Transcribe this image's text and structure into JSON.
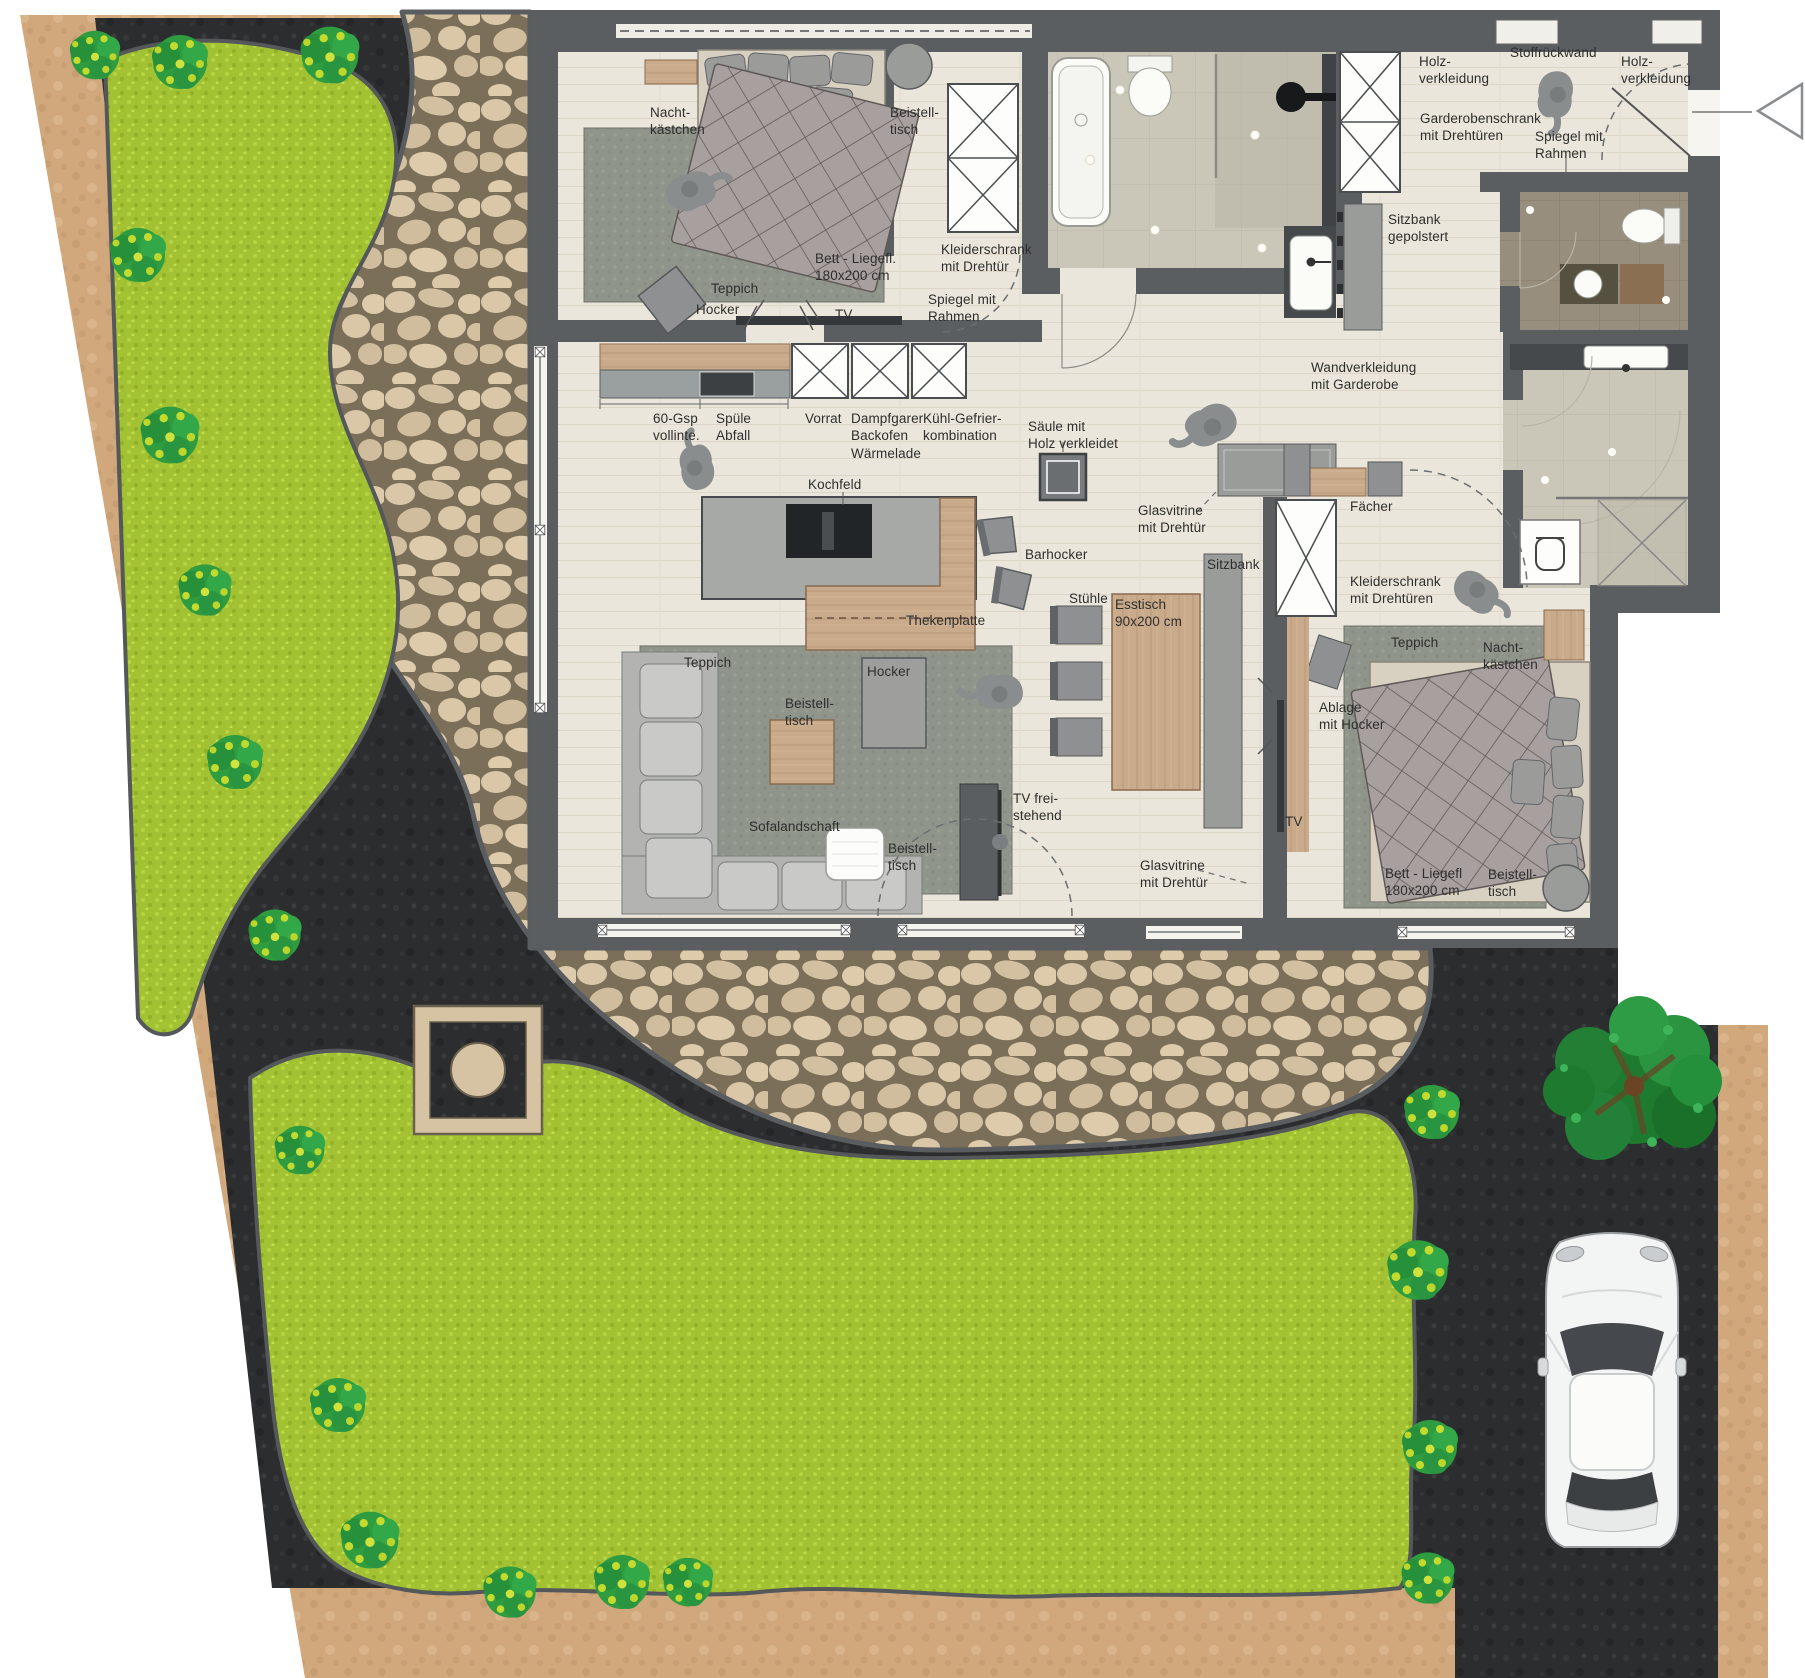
{
  "plan": {
    "canvas": {
      "width": 1805,
      "height": 1678
    },
    "type": "apartment-floor-plan-with-garden",
    "colors": {
      "lawn": "#a2c233",
      "ground": "#2c2d2e",
      "path": "#d0a87c",
      "stone": "#d9c7a8",
      "wall": "#5a5e61",
      "floor": "#ebe6db",
      "furniture_gray": "#9a9c9a",
      "wood": "#c9aa8a",
      "accent_dark": "#36393b"
    },
    "entry_marker": {
      "name": "entry-direction-arrow",
      "shape": "triangle-pointing-left"
    },
    "labels": [
      {
        "id": "bed1-nachtkaestchen",
        "text": "Nacht-\nkästchen",
        "x": 650,
        "y": 104
      },
      {
        "id": "bed1-beistelltisch",
        "text": "Beistell-\ntisch",
        "x": 890,
        "y": 104
      },
      {
        "id": "bed1-bett",
        "text": "Bett - Liegefl.\n180x200 cm",
        "x": 815,
        "y": 250
      },
      {
        "id": "bed1-teppich",
        "text": "Teppich",
        "x": 711,
        "y": 280
      },
      {
        "id": "bed1-hocker",
        "text": "Hocker",
        "x": 696,
        "y": 301
      },
      {
        "id": "bed1-tv",
        "text": "TV",
        "x": 835,
        "y": 306
      },
      {
        "id": "bed1-kleiderschrank",
        "text": "Kleiderschrank\nmit Drehtür",
        "x": 941,
        "y": 241
      },
      {
        "id": "bed1-spiegel",
        "text": "Spiegel mit\nRahmen",
        "x": 928,
        "y": 291
      },
      {
        "id": "kitchen-gsp",
        "text": "60-Gsp\nvollinte.",
        "x": 653,
        "y": 410
      },
      {
        "id": "kitchen-spuele",
        "text": "Spüle\nAbfall",
        "x": 716,
        "y": 410
      },
      {
        "id": "kitchen-vorrat",
        "text": "Vorrat",
        "x": 805,
        "y": 410
      },
      {
        "id": "kitchen-dampfgarer",
        "text": "Dampfgarer\nBackofen\nWärmelade",
        "x": 851,
        "y": 410
      },
      {
        "id": "kitchen-kuehl",
        "text": "Kühl-Gefrier-\nkombination",
        "x": 923,
        "y": 410
      },
      {
        "id": "kitchen-kochfeld",
        "text": "Kochfeld",
        "x": 808,
        "y": 476
      },
      {
        "id": "kitchen-thekenplatte",
        "text": "Thekenplatte",
        "x": 906,
        "y": 612
      },
      {
        "id": "kitchen-barhocker",
        "text": "Barhocker",
        "x": 1025,
        "y": 546
      },
      {
        "id": "kitchen-saeule",
        "text": "Säule mit\nHolz verkleidet",
        "x": 1028,
        "y": 418
      },
      {
        "id": "dining-stuehle",
        "text": "Stühle",
        "x": 1069,
        "y": 590
      },
      {
        "id": "dining-esstisch",
        "text": "Esstisch\n90x200 cm",
        "x": 1115,
        "y": 596
      },
      {
        "id": "dining-sitzbank",
        "text": "Sitzbank",
        "x": 1207,
        "y": 556
      },
      {
        "id": "dining-glasvitrine",
        "text": "Glasvitrine\nmit Drehtür",
        "x": 1138,
        "y": 502
      },
      {
        "id": "living-glasvitrine",
        "text": "Glasvitrine\nmit Drehtür",
        "x": 1140,
        "y": 857
      },
      {
        "id": "hall-wandverkleidung",
        "text": "Wandverkleidung\nmit Garderobe",
        "x": 1311,
        "y": 359
      },
      {
        "id": "entry-holz-left",
        "text": "Holz-\nverkleidung",
        "x": 1419,
        "y": 53
      },
      {
        "id": "entry-stoffrueckwand",
        "text": "Stoffrückwand",
        "x": 1510,
        "y": 44
      },
      {
        "id": "entry-holz-right",
        "text": "Holz-\nverkleidung",
        "x": 1621,
        "y": 53
      },
      {
        "id": "entry-garderobenschrank",
        "text": "Garderobenschrank\nmit Drehtüren",
        "x": 1420,
        "y": 110
      },
      {
        "id": "entry-spiegel",
        "text": "Spiegel mit\nRahmen",
        "x": 1535,
        "y": 128
      },
      {
        "id": "entry-sitzbank",
        "text": "Sitzbank\ngepolstert",
        "x": 1388,
        "y": 211
      },
      {
        "id": "bed2-faecher",
        "text": "Fächer",
        "x": 1350,
        "y": 498
      },
      {
        "id": "bed2-kleiderschrank",
        "text": "Kleiderschrank\nmit Drehtüren",
        "x": 1350,
        "y": 573
      },
      {
        "id": "bed2-teppich",
        "text": "Teppich",
        "x": 1391,
        "y": 634
      },
      {
        "id": "bed2-nachtkaestchen",
        "text": "Nacht-\nkästchen",
        "x": 1483,
        "y": 639
      },
      {
        "id": "bed2-ablage",
        "text": "Ablage\nmit Hocker",
        "x": 1319,
        "y": 699
      },
      {
        "id": "bed2-tv",
        "text": "TV",
        "x": 1285,
        "y": 813
      },
      {
        "id": "bed2-bett",
        "text": "Bett - Liegefl\n180x200 cm",
        "x": 1385,
        "y": 865
      },
      {
        "id": "bed2-beistelltisch",
        "text": "Beistell-\ntisch",
        "x": 1488,
        "y": 866
      },
      {
        "id": "living-teppich",
        "text": "Teppich",
        "x": 684,
        "y": 654
      },
      {
        "id": "living-hocker",
        "text": "Hocker",
        "x": 867,
        "y": 663
      },
      {
        "id": "living-beistelltisch1",
        "text": "Beistell-\ntisch",
        "x": 785,
        "y": 695
      },
      {
        "id": "living-sofalandschaft",
        "text": "Sofalandschaft",
        "x": 749,
        "y": 818
      },
      {
        "id": "living-beistelltisch2",
        "text": "Beistell-\ntisch",
        "x": 888,
        "y": 840
      },
      {
        "id": "living-tv",
        "text": "TV frei-\nstehend",
        "x": 1013,
        "y": 790
      }
    ]
  }
}
